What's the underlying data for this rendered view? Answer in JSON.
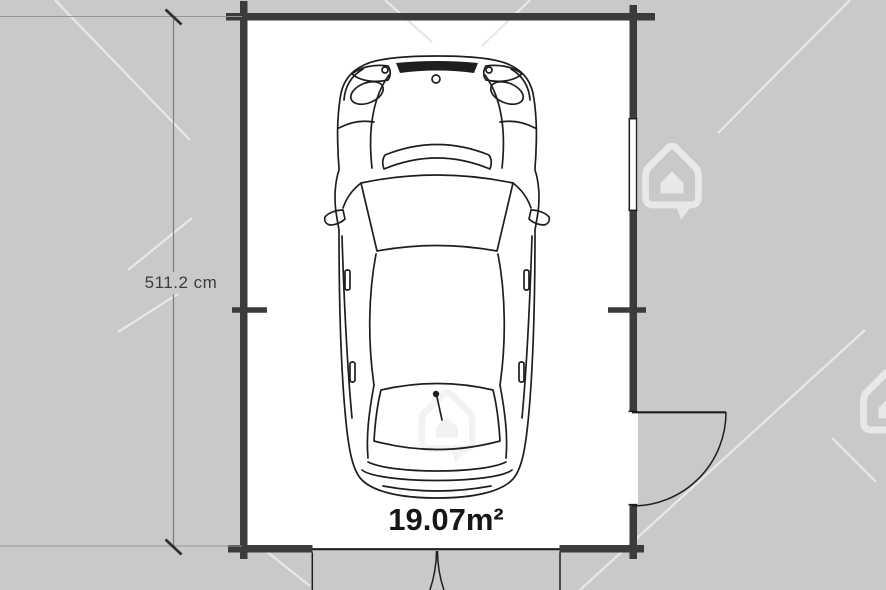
{
  "plan": {
    "dimension_label": "511.2 cm",
    "area_label": "19.07m²",
    "colors": {
      "background": "#cac9c8",
      "floor": "#ffffff",
      "wall": "#3b3b3b",
      "line": "#1e1e1e",
      "dim_line": "#7c7c7c",
      "dim_text": "#3c3c3c",
      "area_text": "#161616",
      "watermark": "#e9e8e7"
    },
    "icons": {
      "watermark": "house-watermark-icon"
    }
  }
}
